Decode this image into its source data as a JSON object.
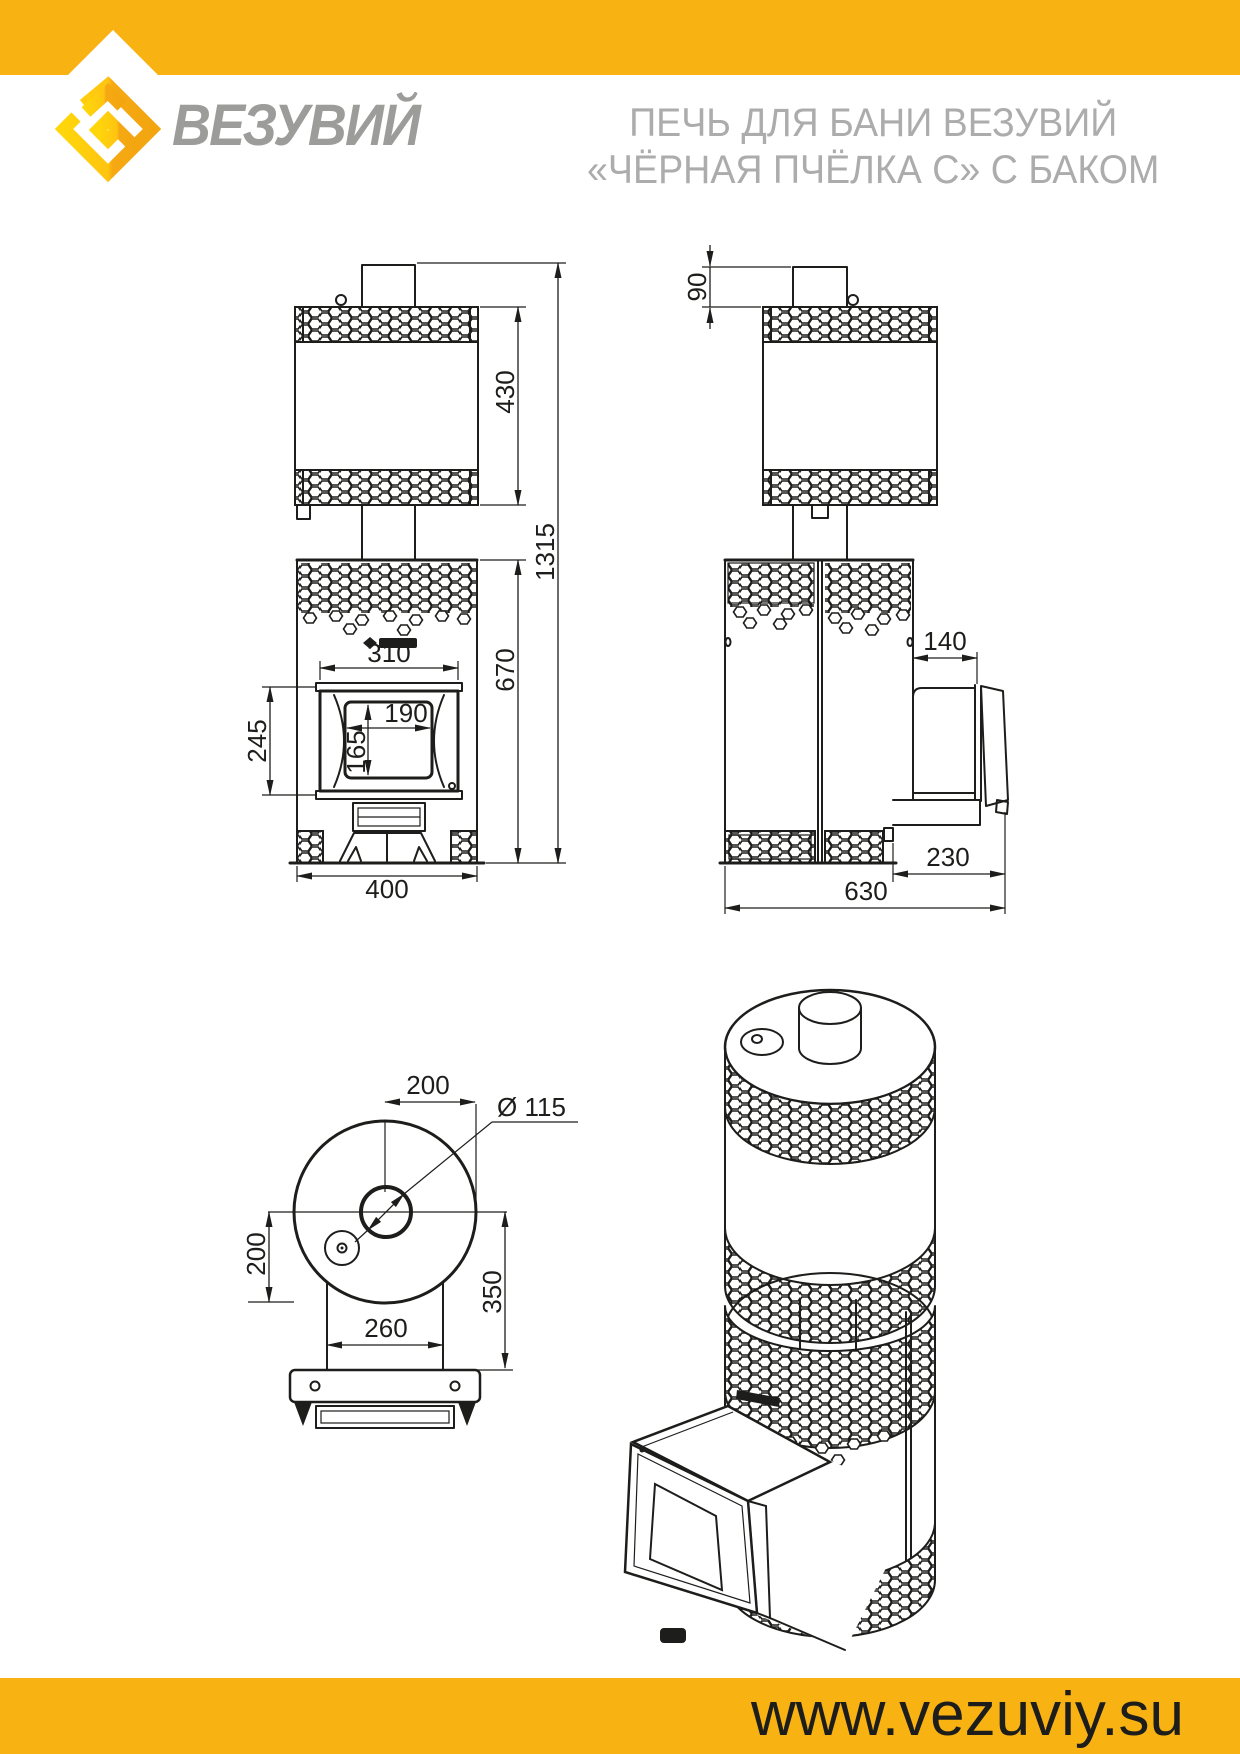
{
  "header": {
    "brand": "ВЕЗУВИЙ",
    "title_line1": "ПЕЧЬ ДЛЯ БАНИ ВЕЗУВИЙ",
    "title_line2": "«ЧЁРНАЯ ПЧЁЛКА С» С БАКОМ",
    "logo_icon": "vezuviy-diamond-logo"
  },
  "footer": {
    "website": "www.vezuviy.su"
  },
  "colors": {
    "brand_yellow": "#F8B312",
    "logo_gold_light": "#FFD60A",
    "logo_gold_dark": "#F6A913",
    "line_black": "#1D1D1B",
    "brand_gray": "#9C9C9B",
    "title_gray": "#ACACAC"
  },
  "dimensions": {
    "front": {
      "tank_height": "430",
      "total_height": "1315",
      "body_height": "670",
      "door_width": "310",
      "glass_width": "190",
      "glass_height": "165",
      "door_height": "245",
      "width": "400"
    },
    "side": {
      "chimney_height": "90",
      "tunnel_top": "140",
      "tunnel_depth": "230",
      "depth": "630"
    },
    "top": {
      "chimney_offset": "200",
      "chimney_diameter": "Ø 115",
      "left_offset": "200",
      "tunnel_extent": "350",
      "tunnel_width": "260"
    }
  }
}
